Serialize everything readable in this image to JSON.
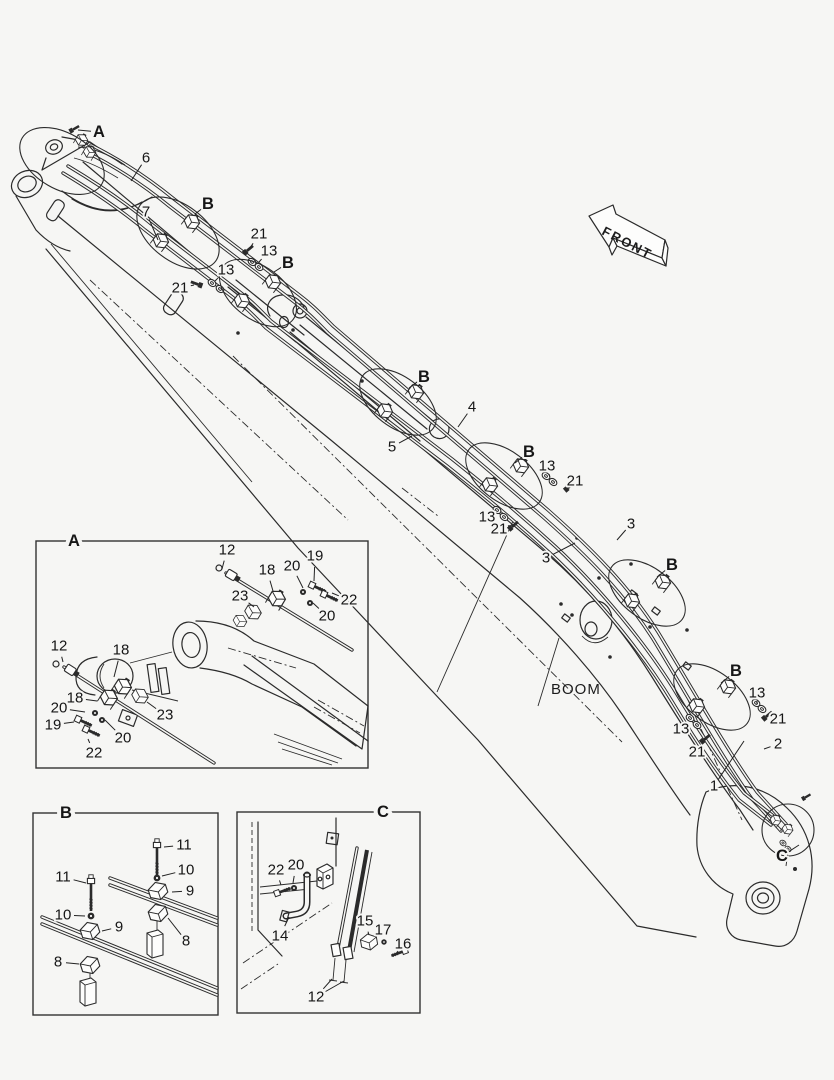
{
  "colors": {
    "bg": "#f6f6f4",
    "ink": "#2b2b2b"
  },
  "labels": {
    "front": "FRONT",
    "boom": "BOOM"
  },
  "diagram": {
    "groups": [
      {
        "id": "callouts-main",
        "items": [
          {
            "t": "A",
            "x": 99,
            "y": 132,
            "b": 1,
            "l": [
              [
                78,
                130
              ]
            ]
          },
          {
            "t": "6",
            "x": 146,
            "y": 158,
            "l": [
              [
                131,
                181
              ]
            ]
          },
          {
            "t": "B",
            "x": 208,
            "y": 204,
            "b": 1,
            "l": [
              [
                195,
                214
              ]
            ]
          },
          {
            "t": "7",
            "x": 146,
            "y": 212,
            "l": [
              [
                158,
                240
              ]
            ]
          },
          {
            "t": "21",
            "x": 259,
            "y": 234,
            "l": [
              [
                250,
                248
              ]
            ]
          },
          {
            "t": "13",
            "x": 269,
            "y": 251,
            "l": [
              [
                259,
                262
              ]
            ]
          },
          {
            "t": "B",
            "x": 288,
            "y": 263,
            "b": 1,
            "l": [
              [
                274,
                272
              ]
            ]
          },
          {
            "t": "13",
            "x": 226,
            "y": 270,
            "l": [
              [
                215,
                281
              ]
            ]
          },
          {
            "t": "21",
            "x": 180,
            "y": 288,
            "l": [
              [
                194,
                285
              ]
            ]
          },
          {
            "t": "B",
            "x": 424,
            "y": 377,
            "b": 1,
            "l": [
              [
                409,
                388
              ]
            ]
          },
          {
            "t": "4",
            "x": 472,
            "y": 407,
            "l": [
              [
                458,
                427
              ]
            ]
          },
          {
            "t": "5",
            "x": 392,
            "y": 447,
            "l": [
              [
                412,
                436
              ]
            ]
          },
          {
            "t": "B",
            "x": 529,
            "y": 452,
            "b": 1,
            "l": [
              [
                515,
                463
              ]
            ]
          },
          {
            "t": "13",
            "x": 547,
            "y": 466,
            "l": [
              [
                549,
                474
              ]
            ]
          },
          {
            "t": "21",
            "x": 575,
            "y": 481,
            "l": [
              [
                566,
                486
              ]
            ]
          },
          {
            "t": "13",
            "x": 487,
            "y": 517,
            "l": [
              [
                494,
                511
              ]
            ]
          },
          {
            "t": "21",
            "x": 499,
            "y": 529,
            "l": [
              [
                508,
                526
              ]
            ]
          },
          {
            "t": "3",
            "x": 631,
            "y": 524,
            "l": [
              [
                617,
                540
              ]
            ]
          },
          {
            "t": "3",
            "x": 546,
            "y": 558,
            "l": [
              [
                575,
                543
              ]
            ]
          },
          {
            "t": "B",
            "x": 672,
            "y": 565,
            "b": 1,
            "l": [
              [
                657,
                577
              ]
            ]
          },
          {
            "t": "B",
            "x": 736,
            "y": 671,
            "b": 1,
            "l": [
              [
                721,
                683
              ]
            ]
          },
          {
            "t": "13",
            "x": 757,
            "y": 693,
            "l": [
              [
                757,
                701
              ]
            ]
          },
          {
            "t": "21",
            "x": 778,
            "y": 719,
            "l": [
              [
                770,
                716
              ]
            ]
          },
          {
            "t": "13",
            "x": 681,
            "y": 729,
            "l": [
              [
                688,
                720
              ]
            ]
          },
          {
            "t": "2",
            "x": 778,
            "y": 744,
            "l": [
              [
                764,
                749
              ]
            ]
          },
          {
            "t": "21",
            "x": 697,
            "y": 752,
            "l": [
              [
                703,
                741
              ]
            ]
          },
          {
            "t": "1",
            "x": 714,
            "y": 786,
            "l": [
              [
                744,
                741
              ]
            ]
          },
          {
            "t": "C",
            "x": 782,
            "y": 856,
            "b": 1,
            "l": [
              [
                799,
                845
              ]
            ]
          }
        ]
      },
      {
        "id": "callouts-a",
        "items": [
          {
            "t": "A",
            "x": 74,
            "y": 541,
            "b": 1,
            "h": 8
          },
          {
            "t": "12",
            "x": 227,
            "y": 550,
            "l": [
              [
                222,
                569
              ]
            ]
          },
          {
            "t": "18",
            "x": 267,
            "y": 570,
            "l": [
              [
                273,
                591
              ]
            ]
          },
          {
            "t": "20",
            "x": 292,
            "y": 566,
            "l": [
              [
                303,
                588
              ]
            ]
          },
          {
            "t": "19",
            "x": 315,
            "y": 556,
            "l": [
              [
                314,
                581
              ]
            ]
          },
          {
            "t": "22",
            "x": 349,
            "y": 600,
            "l": [
              [
                332,
                593
              ]
            ]
          },
          {
            "t": "20",
            "x": 327,
            "y": 616,
            "l": [
              [
                313,
                603
              ]
            ]
          },
          {
            "t": "23",
            "x": 240,
            "y": 596,
            "l": [
              [
                254,
                607
              ]
            ]
          },
          {
            "t": "12",
            "x": 59,
            "y": 646,
            "l": [
              [
                63,
                662
              ]
            ]
          },
          {
            "t": "18",
            "x": 121,
            "y": 650,
            "l": [
              [
                114,
                677
              ]
            ]
          },
          {
            "t": "18",
            "x": 75,
            "y": 698,
            "l": [
              [
                97,
                701
              ]
            ]
          },
          {
            "t": "20",
            "x": 59,
            "y": 708,
            "l": [
              [
                85,
                712
              ]
            ]
          },
          {
            "t": "19",
            "x": 53,
            "y": 725,
            "l": [
              [
                74,
                722
              ]
            ]
          },
          {
            "t": "22",
            "x": 94,
            "y": 753,
            "l": [
              [
                88,
                739
              ]
            ]
          },
          {
            "t": "20",
            "x": 123,
            "y": 738,
            "l": [
              [
                105,
                720
              ]
            ]
          },
          {
            "t": "23",
            "x": 165,
            "y": 715,
            "l": [
              [
                147,
                702
              ]
            ]
          }
        ]
      },
      {
        "id": "callouts-b",
        "items": [
          {
            "t": "B",
            "x": 66,
            "y": 813,
            "b": 1,
            "h": 8
          },
          {
            "t": "11",
            "x": 184,
            "y": 845,
            "l": [
              [
                164,
                847
              ]
            ]
          },
          {
            "t": "10",
            "x": 186,
            "y": 870,
            "l": [
              [
                162,
                876
              ]
            ]
          },
          {
            "t": "9",
            "x": 190,
            "y": 891,
            "l": [
              [
                172,
                892
              ]
            ]
          },
          {
            "t": "11",
            "x": 63,
            "y": 877,
            "l": [
              [
                86,
                883
              ]
            ]
          },
          {
            "t": "10",
            "x": 63,
            "y": 915,
            "l": [
              [
                85,
                916
              ]
            ]
          },
          {
            "t": "9",
            "x": 119,
            "y": 927,
            "l": [
              [
                102,
                931
              ]
            ]
          },
          {
            "t": "8",
            "x": 186,
            "y": 941,
            "l": [
              [
                168,
                918
              ]
            ]
          },
          {
            "t": "8",
            "x": 58,
            "y": 962,
            "l": [
              [
                79,
                964
              ]
            ]
          }
        ]
      },
      {
        "id": "callouts-c",
        "items": [
          {
            "t": "C",
            "x": 383,
            "y": 812,
            "b": 1,
            "h": 8
          },
          {
            "t": "22",
            "x": 276,
            "y": 870,
            "l": [
              [
                281,
                885
              ]
            ]
          },
          {
            "t": "20",
            "x": 296,
            "y": 865,
            "l": [
              [
                293,
                883
              ]
            ]
          },
          {
            "t": "14",
            "x": 280,
            "y": 936,
            "l": [
              [
                289,
                917
              ]
            ]
          },
          {
            "t": "15",
            "x": 365,
            "y": 921,
            "l": [
              [
                369,
                935
              ]
            ]
          },
          {
            "t": "17",
            "x": 383,
            "y": 930,
            "l": [
              [
                384,
                941
              ]
            ]
          },
          {
            "t": "16",
            "x": 403,
            "y": 944,
            "l": [
              [
                398,
                951
              ]
            ]
          },
          {
            "t": "12",
            "x": 316,
            "y": 997,
            "l": [
              [
                332,
                979
              ],
              [
                344,
                981
              ]
            ]
          }
        ]
      }
    ]
  }
}
